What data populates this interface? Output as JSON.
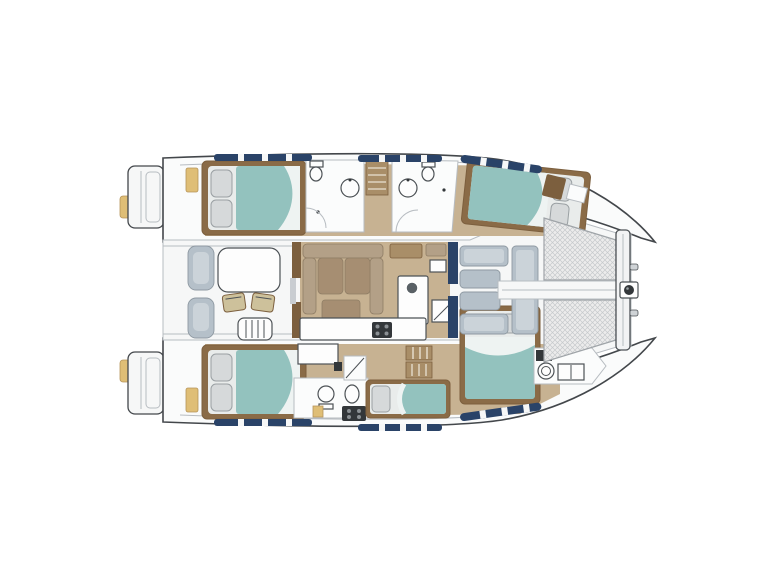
{
  "diagram": {
    "type": "yacht-floor-plan",
    "subject": "Catamaran sailing yacht accommodation layout, top-down plan view, bow to the right",
    "orientation": {
      "bow": "right",
      "stern": "left"
    },
    "features": {
      "double_cabins": 4,
      "single_berths": 1,
      "heads": 4,
      "trampolines": 2,
      "cockpits": 2
    },
    "areas": [
      {
        "id": "swim-platform-port",
        "label": "Swim platform (port)"
      },
      {
        "id": "swim-platform-starboard",
        "label": "Swim platform (starboard)"
      },
      {
        "id": "aft-cockpit",
        "label": "Aft cockpit with dining table and chairs"
      },
      {
        "id": "salon",
        "label": "Salon with U-shaped sofa"
      },
      {
        "id": "galley",
        "label": "Galley with stove, sink and fridge"
      },
      {
        "id": "cabin-port-aft",
        "label": "Double cabin (port aft)"
      },
      {
        "id": "cabin-port-forward",
        "label": "Double cabin (port forward)"
      },
      {
        "id": "cabin-starboard-aft",
        "label": "Double cabin (starboard aft)"
      },
      {
        "id": "cabin-starboard-forward",
        "label": "Double cabin (starboard forward)"
      },
      {
        "id": "single-berth",
        "label": "Single berth (starboard hull)"
      },
      {
        "id": "head-port-aft",
        "label": "Bathroom (port aft)"
      },
      {
        "id": "head-port-forward",
        "label": "Bathroom (port forward)"
      },
      {
        "id": "head-starboard",
        "label": "Bathroom (starboard)"
      },
      {
        "id": "head-starboard-bow",
        "label": "Bow head (starboard)"
      },
      {
        "id": "forward-cockpit",
        "label": "Forward cockpit lounge"
      },
      {
        "id": "trampoline-port",
        "label": "Trampoline net (port)"
      },
      {
        "id": "trampoline-starboard",
        "label": "Trampoline net (starboard)"
      },
      {
        "id": "bow-crossbeam",
        "label": "Bow crossbeam with anchor roller"
      }
    ]
  },
  "colors": {
    "background": "#ffffff",
    "hull_outline": "#43474b",
    "hull_fill": "#fafbfb",
    "deck_white": "#f6f7f7",
    "line_light": "#b7bcc1",
    "wood_floor": "#c7b292",
    "wood_mid": "#a98e68",
    "wood_dark": "#7c5f3e",
    "bed_frame": "#8a6b47",
    "bed_teal": "#93c2be",
    "pillow": "#d6d9da",
    "pillow_stroke": "#9aa0a3",
    "sofa_taupe": "#b3a087",
    "sofa_brown": "#a68e72",
    "chair_khaki": "#cdc19b",
    "lounge_gray": "#b5c0c9",
    "lounge_gray_light": "#cbd3d9",
    "navy": "#2a4368",
    "accent_yellow": "#dfbe76",
    "appliance_dark": "#33373a",
    "fixture_stroke": "#4d5256",
    "tramp_base": "#ececec",
    "tramp_line": "#c6c9cc"
  }
}
